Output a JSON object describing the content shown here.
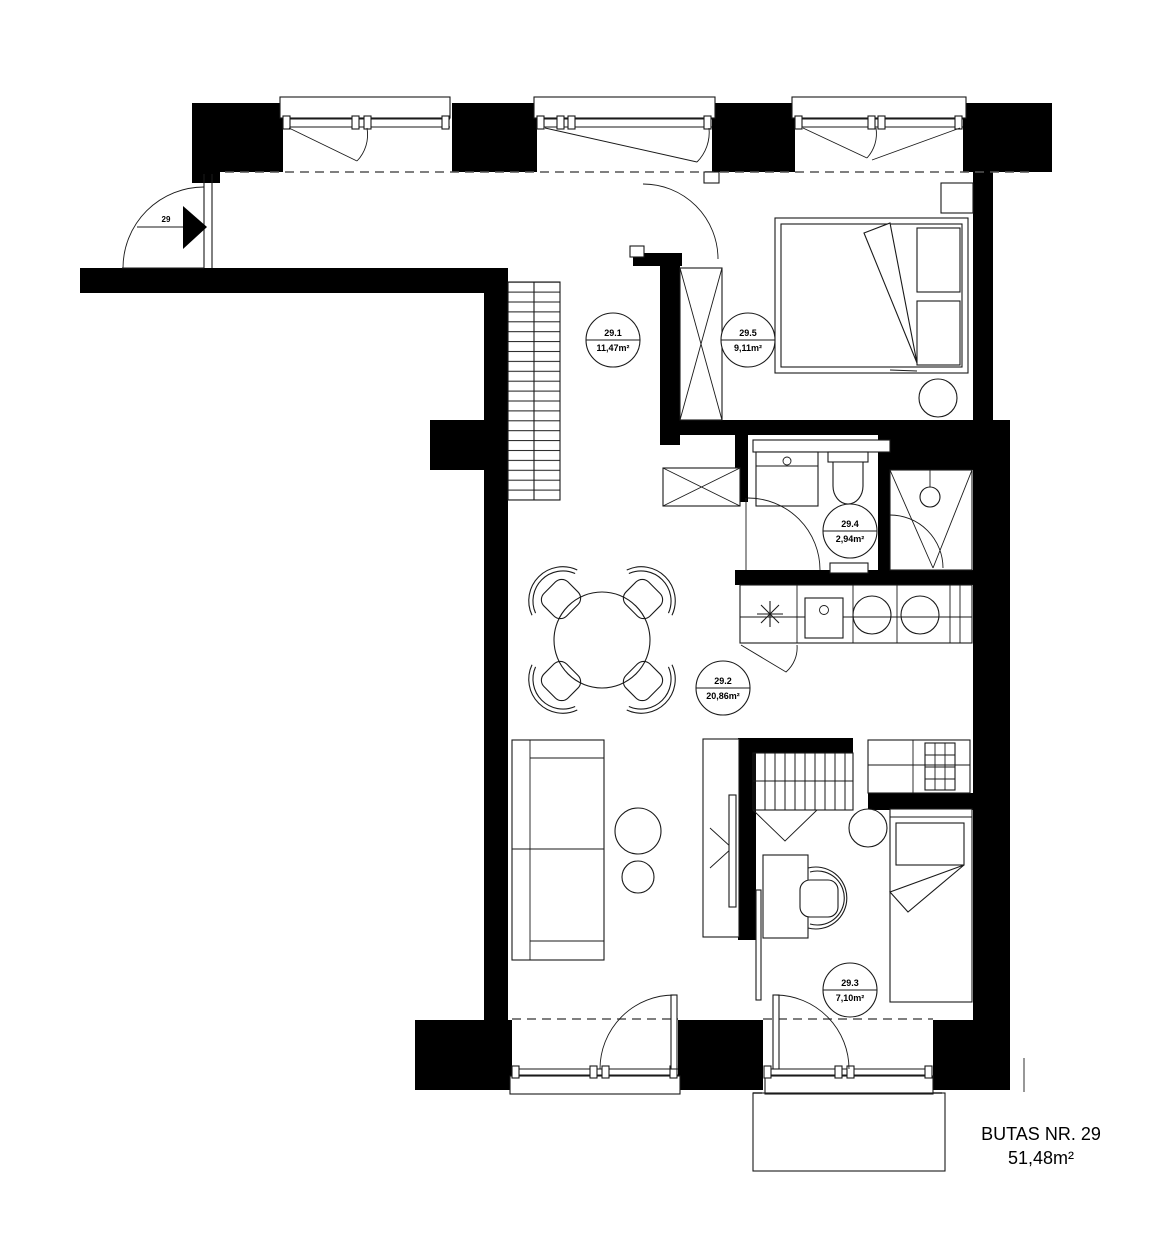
{
  "title": {
    "line1": "BUTAS NR. 29",
    "line2": "51,48m²"
  },
  "entrance": {
    "number": "29"
  },
  "rooms": [
    {
      "id": "29.1",
      "area": "11,47m²"
    },
    {
      "id": "29.2",
      "area": "20,86m²"
    },
    {
      "id": "29.3",
      "area": "7,10m²"
    },
    {
      "id": "29.4",
      "area": "2,94m²"
    },
    {
      "id": "29.5",
      "area": "9,11m²"
    }
  ]
}
